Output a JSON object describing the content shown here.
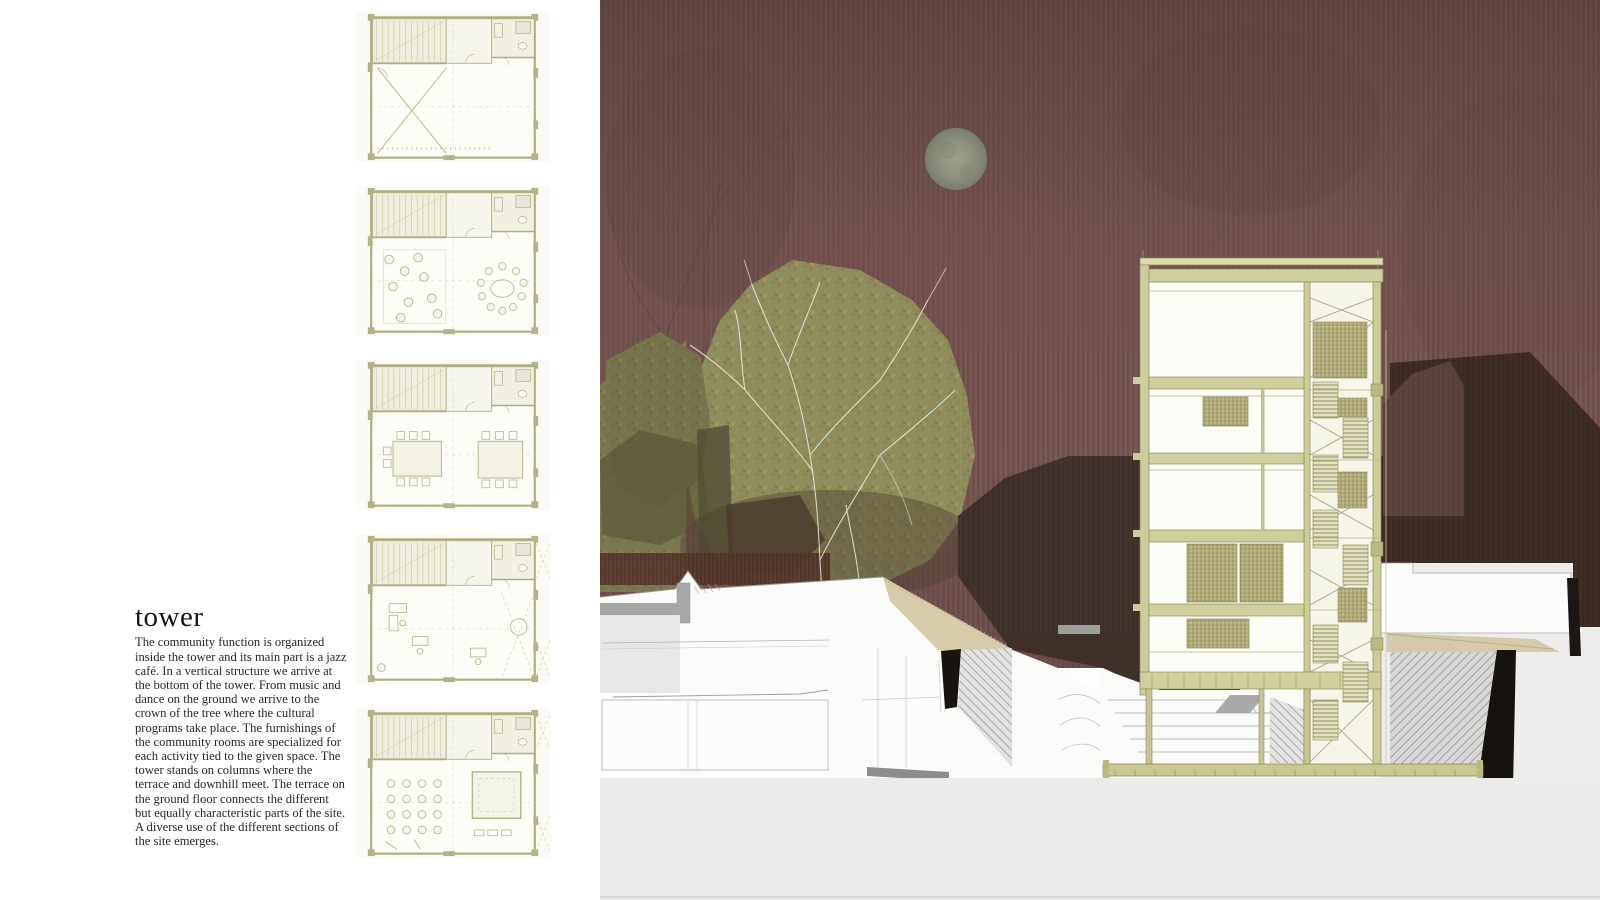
{
  "article": {
    "title": "tower",
    "body": "The community function is organized inside the tower and its main part is a jazz café. In a vertical structure we arrive at the bottom of the tower. From music and dance on the ground we arrive to the crown of the tree where the cultural programs take place. The furnishings of the community rooms are specialized for each activity tied to the given space. The tower stands on columns where the terrace and downhill meet. The terrace on the ground floor connects the different but equally characteristic parts of the site. A diverse use of the different sections of the site emerges."
  },
  "plans": {
    "items": [
      {
        "name": "floor-plan-top-level"
      },
      {
        "name": "floor-plan-cafe-level"
      },
      {
        "name": "floor-plan-meeting-level"
      },
      {
        "name": "floor-plan-office-level"
      },
      {
        "name": "floor-plan-performance-level"
      }
    ]
  },
  "rendering": {
    "elements": [
      "night-sky",
      "moon",
      "autumn-tree",
      "hillside-buildings",
      "tower-section",
      "stair-shaft",
      "amphitheater-steps",
      "terrace-deck",
      "neighbor-roof-silhouettes"
    ],
    "colors": {
      "sky": "#6f504d",
      "moon": "#919682",
      "tree": "#8c8c5d",
      "olive_structure": "#a8a874",
      "khaki_panel": "#beb887",
      "tan_terrace": "#d8cdaa",
      "silhouette_brown": "#3e2d25",
      "maroon_roof": "#5a413c",
      "ground_gray": "#ececea",
      "black_wall": "#16120e"
    }
  }
}
